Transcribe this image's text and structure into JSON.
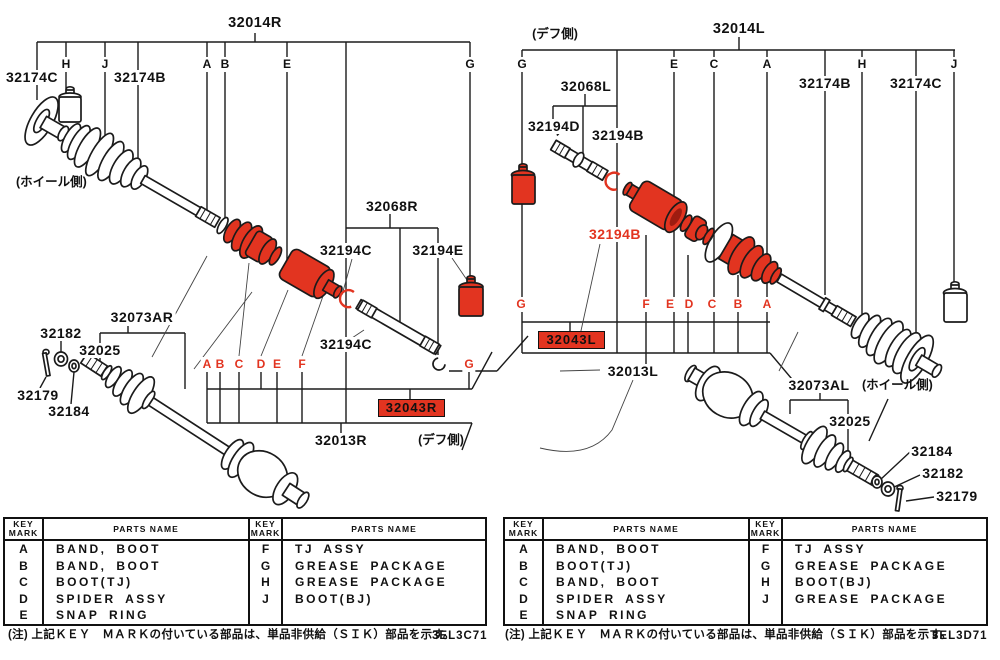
{
  "colors": {
    "red": "#e23420",
    "line": "#1b1b1b"
  },
  "left": {
    "title": "32014R",
    "wheel_side": "(ホイール側)",
    "diff_side": "(デフ側)",
    "marks_top": [
      "H",
      "J",
      "A",
      "B",
      "E",
      "G"
    ],
    "marks_red": [
      "A",
      "B",
      "C",
      "D",
      "E",
      "F",
      "G"
    ],
    "p32174c": "32174C",
    "p32174b": "32174B",
    "p32068": "32068R",
    "p32194c_u": "32194C",
    "p32194e": "32194E",
    "p32194c_l": "32194C",
    "box": "32043R",
    "p32013": "32013R",
    "p32073": "32073AR",
    "p32182": "32182",
    "p32025": "32025",
    "p32179": "32179",
    "p32184": "32184"
  },
  "right": {
    "title": "32014L",
    "diff_side": "(デフ側)",
    "wheel_side": "(ホイール側)",
    "marks_top": [
      "G",
      "E",
      "C",
      "A",
      "H",
      "J"
    ],
    "marks_red": [
      "G",
      "F",
      "E",
      "D",
      "C",
      "B",
      "A"
    ],
    "p32174b": "32174B",
    "p32174c": "32174C",
    "p32068": "32068L",
    "p32194d": "32194D",
    "p32194b_top": "32194B",
    "p32194b_red": "32194B",
    "box": "32043L",
    "p32013": "32013L",
    "p32073": "32073AL",
    "p32025": "32025",
    "p32184": "32184",
    "p32182": "32182",
    "p32179": "32179"
  },
  "tables": {
    "header_key": "KEY MARK",
    "header_parts": "PARTS NAME",
    "left": {
      "rows": [
        [
          "A",
          "BAND, BOOT",
          "F",
          "TJ ASSY"
        ],
        [
          "B",
          "BAND, BOOT",
          "G",
          "GREASE PACKAGE"
        ],
        [
          "C",
          "BOOT(TJ)",
          "H",
          "GREASE PACKAGE"
        ],
        [
          "D",
          "SPIDER ASSY",
          "J",
          "BOOT(BJ)"
        ],
        [
          "E",
          "SNAP RING",
          "",
          ""
        ]
      ],
      "code": "3EL3C71"
    },
    "right": {
      "rows": [
        [
          "A",
          "BAND, BOOT",
          "F",
          "TJ ASSY"
        ],
        [
          "B",
          "BOOT(TJ)",
          "G",
          "GREASE PACKAGE"
        ],
        [
          "C",
          "BAND, BOOT",
          "H",
          "BOOT(BJ)"
        ],
        [
          "D",
          "SPIDER ASSY",
          "J",
          "GREASE PACKAGE"
        ],
        [
          "E",
          "SNAP RING",
          "",
          ""
        ]
      ],
      "code": "3EL3D71"
    },
    "note": "(注) 上記ＫＥＹ　ＭＡＲＫの付いている部品は、単品非供給（ＳＩＫ）部品を示す。"
  }
}
